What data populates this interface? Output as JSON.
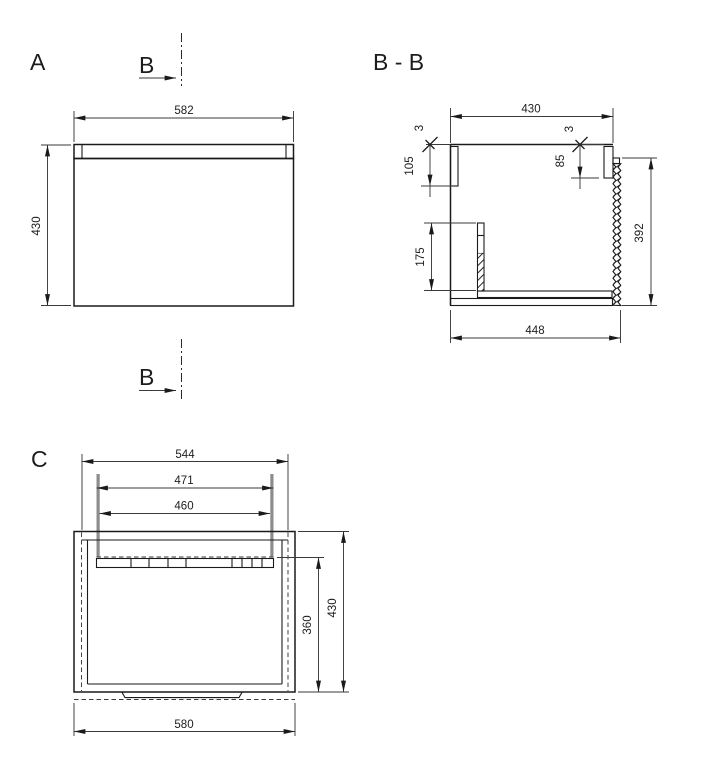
{
  "sheet": {
    "views": {
      "a": {
        "label": "A"
      },
      "bb": {
        "label": "B - B"
      },
      "c": {
        "label": "C"
      }
    },
    "section_marker": {
      "label": "B"
    },
    "dims": {
      "a_width": "582",
      "a_height": "430",
      "bb_top_width": "430",
      "bb_left_offset": "3",
      "bb_right_offset": "3",
      "bb_left_wall": "105",
      "bb_right_wall": "85",
      "bb_front_height": "392",
      "bb_divider": "175",
      "bb_bottom_width": "448",
      "c_top_width": "544",
      "c_rail_outer": "471",
      "c_rail_inner": "460",
      "c_inner_depth": "360",
      "c_depth": "430",
      "c_width": "580"
    }
  }
}
